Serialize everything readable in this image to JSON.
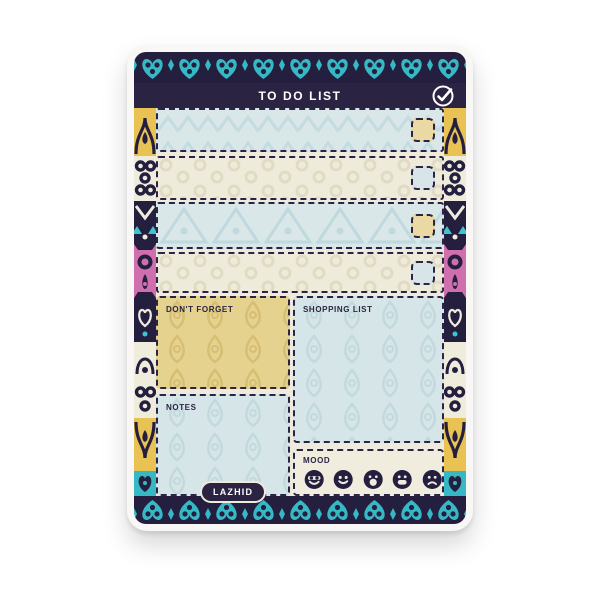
{
  "product": {
    "brand": "LAZHID",
    "header": {
      "title": "TO DO LIST",
      "icon": "check-circle-icon"
    },
    "todo_rows": [
      {
        "bg": "#d9e7e9",
        "checkbox_color": "#ead9a2",
        "pattern": "hearts"
      },
      {
        "bg": "#efebda",
        "checkbox_color": "#d7e5e8",
        "pattern": "rings"
      },
      {
        "bg": "#d9e7e9",
        "checkbox_color": "#ead9a2",
        "pattern": "triangles"
      },
      {
        "bg": "#efebda",
        "checkbox_color": "#d7e5e8",
        "pattern": "rings"
      }
    ],
    "sections": {
      "dont_forget": {
        "label": "DON'T FORGET",
        "bg": "#e6d28f"
      },
      "shopping_list": {
        "label": "SHOPPING LIST",
        "bg": "#d6e5e7"
      },
      "notes": {
        "label": "NOTES",
        "bg": "#d6e5e7"
      },
      "mood": {
        "label": "MOOD",
        "bg": "#f0edde",
        "icons": [
          "cool-face-icon",
          "smile-face-icon",
          "surprised-face-icon",
          "grinning-face-icon",
          "sad-face-icon"
        ]
      }
    },
    "colors": {
      "navy": "#2a2342",
      "teal": "#37b9c5",
      "yellow": "#e9c254",
      "pink": "#d06fae",
      "cream": "#efebdc",
      "light_blue": "#d9e7e9",
      "tan": "#ead9a2",
      "frame_white": "#f8f7f5"
    }
  }
}
